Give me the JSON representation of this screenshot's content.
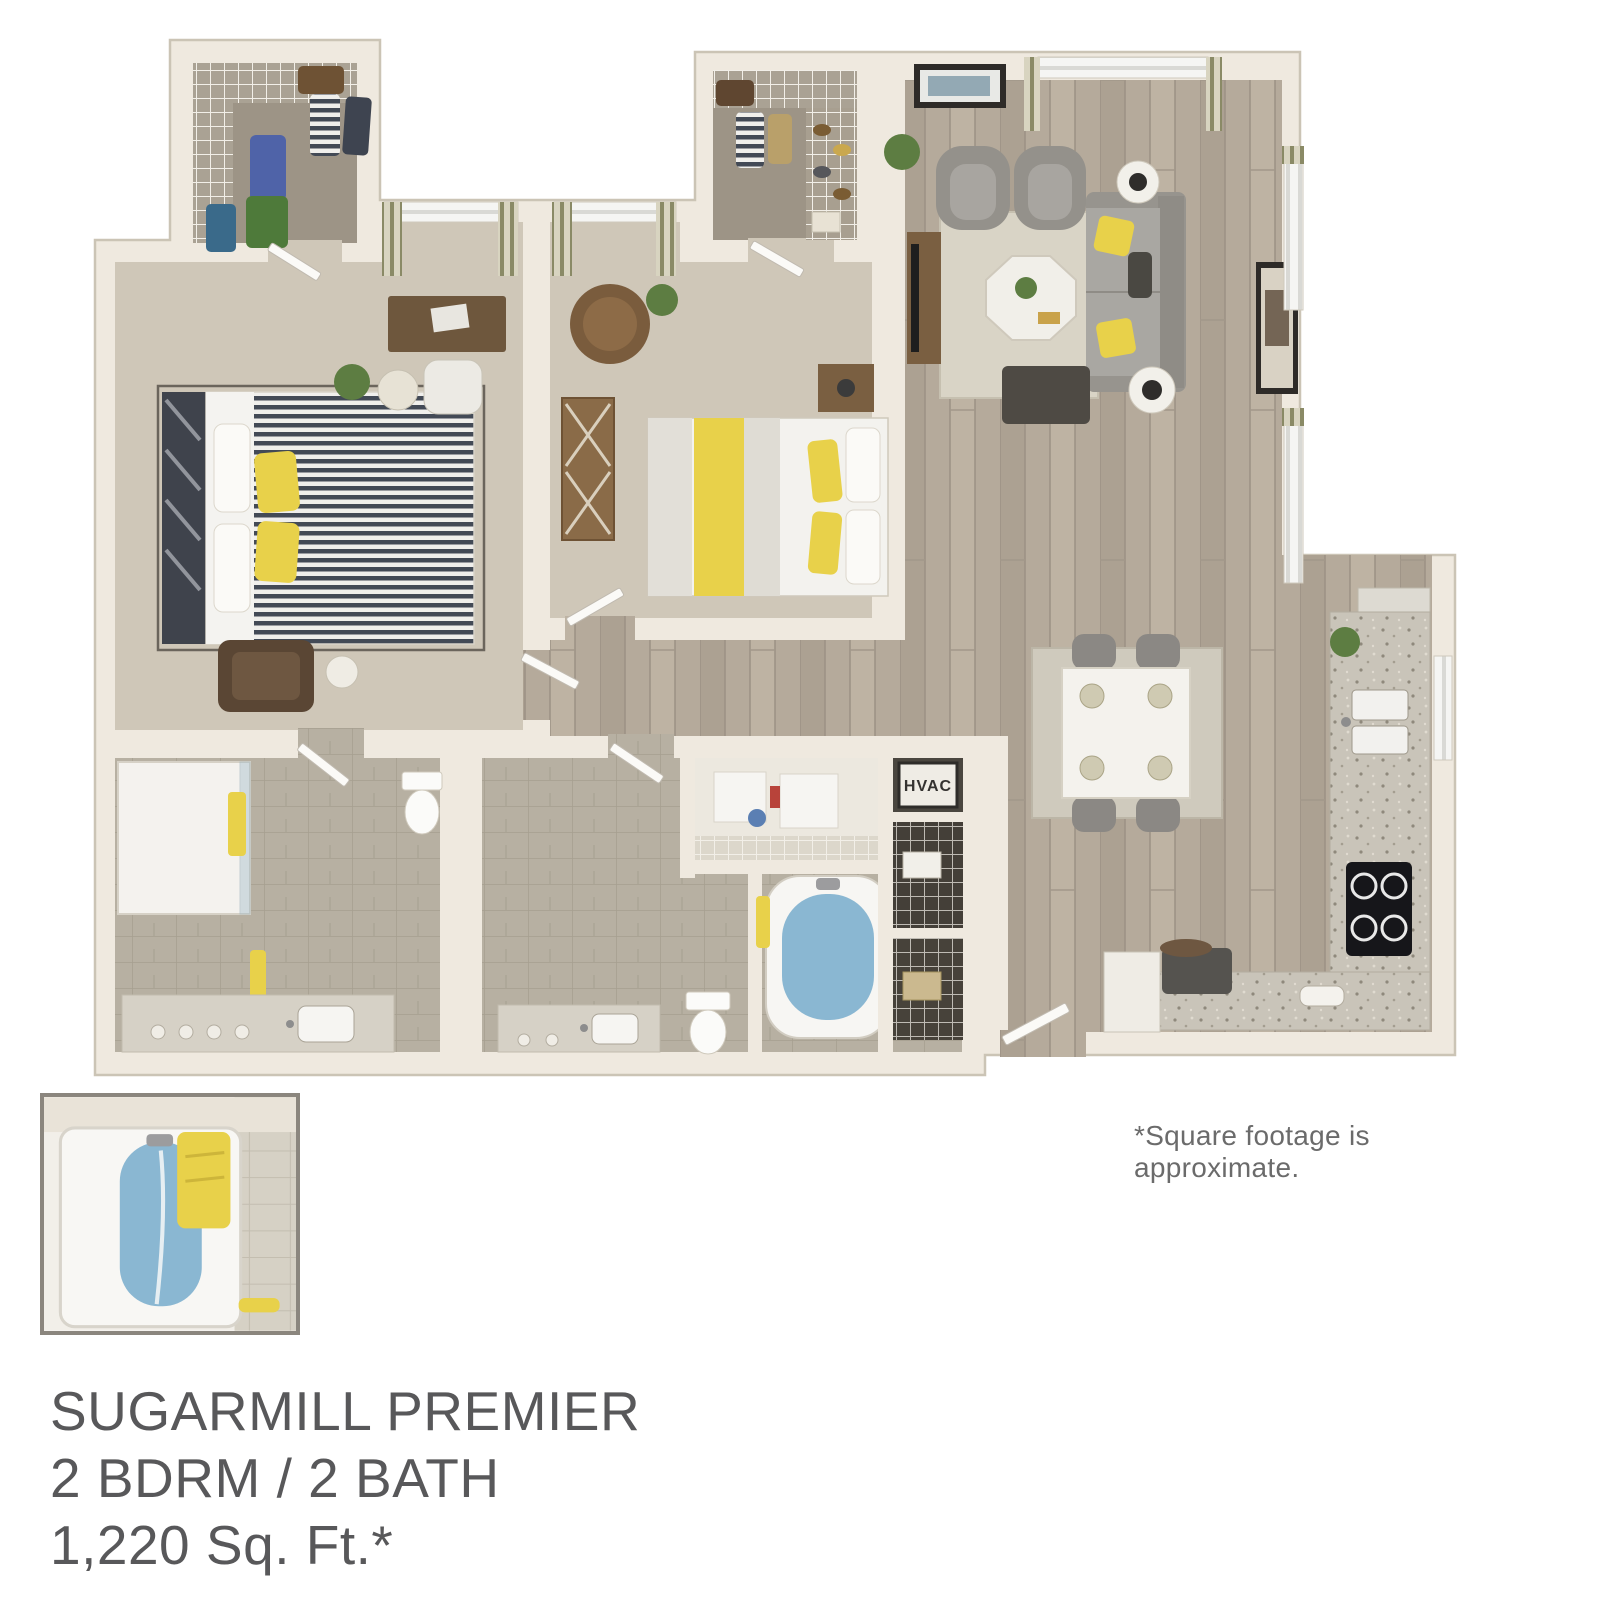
{
  "floor_plan": {
    "hvac_label": "HVAC",
    "footnote": "*Square footage is approximate.",
    "title_line1": "SUGARMILL PREMIER",
    "title_line2": "2 BDRM / 2 BATH",
    "title_line3": "1,220 Sq. Ft.*"
  },
  "colors": {
    "background": "#ffffff",
    "wall": "#efe9df",
    "wall_outline": "#cbc4b5",
    "wood_floor": "#b5aa9b",
    "carpet": "#cfc7b8",
    "closet_carpet": "#9d9486",
    "bath_tile": "#b7b0a2",
    "accent_yellow": "#e8d14a",
    "tub_blue": "#8ab7d2",
    "sofa_gray": "#a9a7a2",
    "dark_furniture": "#4e4a44",
    "wood_furniture": "#7a5f41",
    "granite": "#c9c4b9",
    "plant_green": "#5d7d42",
    "text_dark": "#58585a",
    "text_light": "#6b6b6b",
    "inset_border": "#8b867e"
  }
}
